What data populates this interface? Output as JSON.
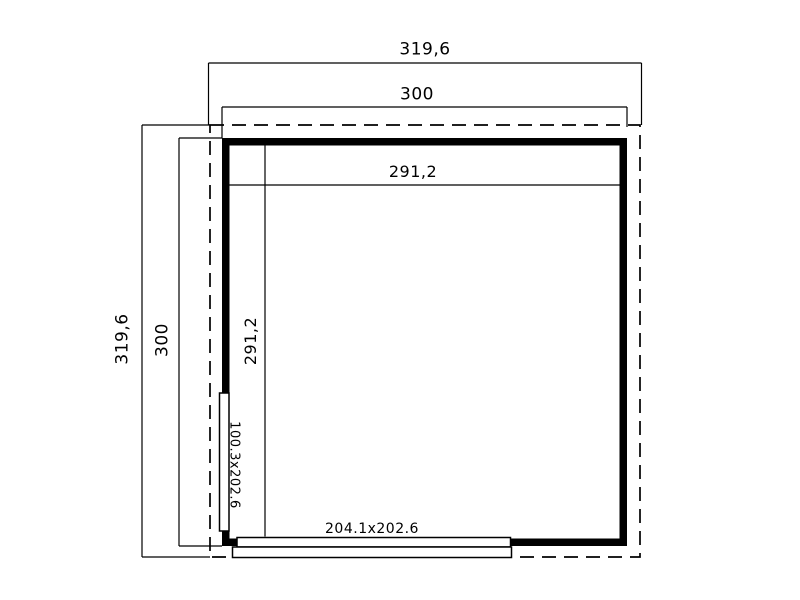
{
  "plan": {
    "kind": "floor-plan",
    "labels": {
      "outer_width": "319,6",
      "outer_depth": "319,6",
      "frame_width": "300",
      "frame_depth": "300",
      "interior_width": "291,2",
      "interior_depth": "291,2",
      "side_window_size": "100.3x202.6",
      "front_door_size": "204.1x202.6"
    },
    "colors": {
      "line": "#000000",
      "background": "#ffffff"
    }
  }
}
